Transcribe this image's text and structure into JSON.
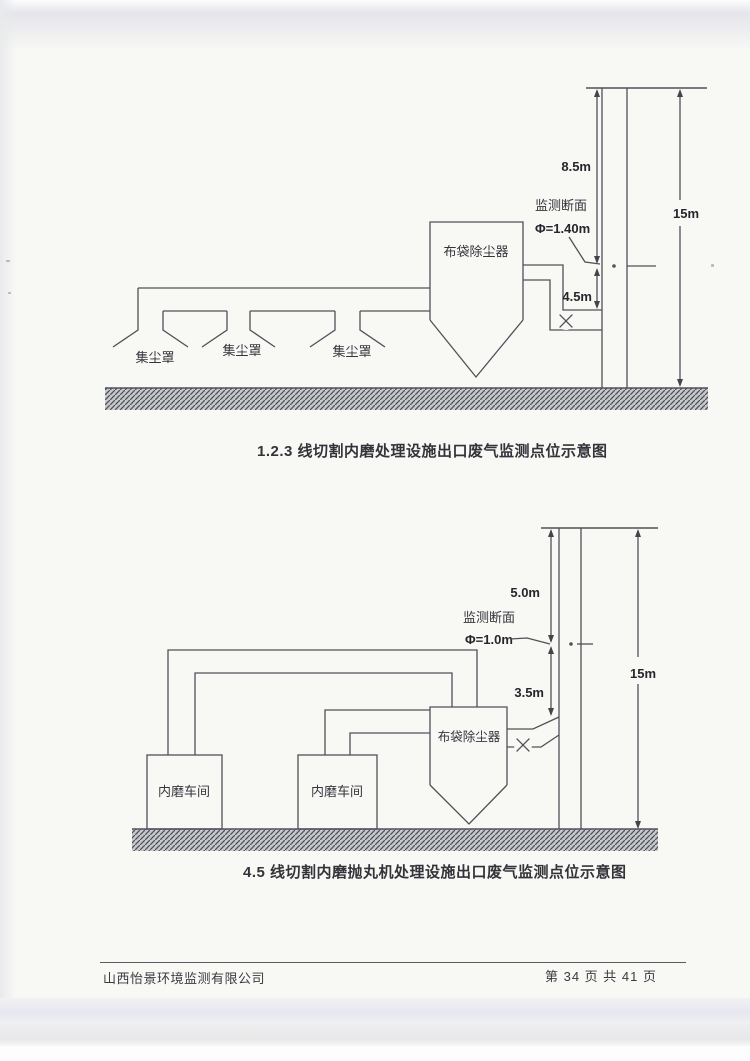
{
  "diagram1": {
    "caption": "1.2.3 线切割内磨处理设施出口废气监测点位示意图",
    "labels": {
      "collector": "布袋除尘器",
      "hood1": "集尘罩",
      "hood2": "集尘罩",
      "hood3": "集尘罩",
      "monitor_section": "监测断面",
      "diameter": "Φ=1.40m",
      "dim_upper": "8.5m",
      "dim_lower": "4.5m",
      "dim_total": "15m"
    }
  },
  "diagram2": {
    "caption": "4.5 线切割内磨抛丸机处理设施出口废气监测点位示意图",
    "labels": {
      "workshop1": "内磨车间",
      "workshop2": "内磨车间",
      "collector": "布袋除尘器",
      "monitor_section": "监测断面",
      "diameter": "Φ=1.0m",
      "dim_upper": "5.0m",
      "dim_lower": "3.5m",
      "dim_total": "15m"
    }
  },
  "footer": {
    "company": "山西怡景环境监测有限公司",
    "page_info": "第 34 页 共 41 页"
  },
  "colors": {
    "line": "#50505a",
    "paper": "#f8f8f5",
    "hatch_base": "#c6c9cc",
    "hatch_line": "#7d8186"
  }
}
